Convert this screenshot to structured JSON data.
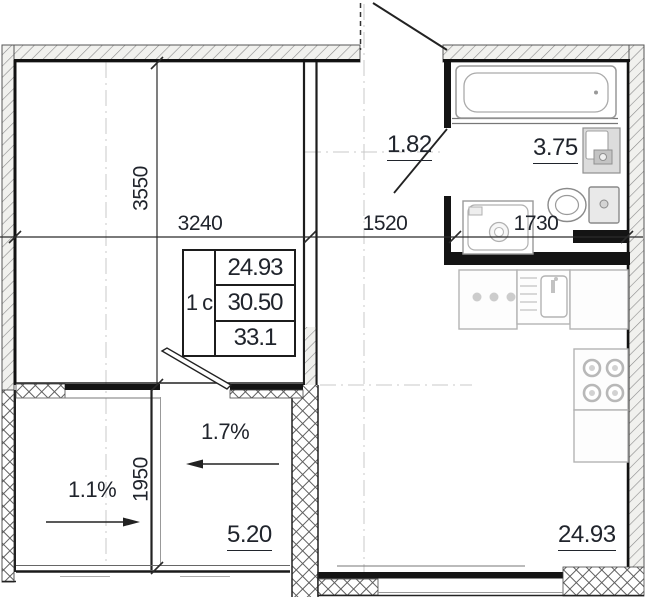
{
  "colors": {
    "wall_fill": "#141414",
    "annotation_text": "#20242c",
    "fixture_stroke": "#9a9a9a",
    "axis_gray": "#c8c8c8"
  },
  "floor_plan": {
    "unit_type": "1 с",
    "area_table": {
      "living": "24.93",
      "total": "30.50",
      "total_with_balcony": "33.1"
    },
    "dimensions": {
      "room_width_mm": "3240",
      "room_depth_mm": "3550",
      "hall_width_mm": "1520",
      "bathroom_width_mm": "1730",
      "balcony_depth_mm": "1950"
    },
    "room_areas": {
      "hallway_m2": "1.82",
      "bathroom_m2": "3.75",
      "balcony_m2": "5.20",
      "living_kitchen_m2": "24.93"
    },
    "slope_labels": {
      "left": "1.1%",
      "right": "1.7%"
    }
  }
}
